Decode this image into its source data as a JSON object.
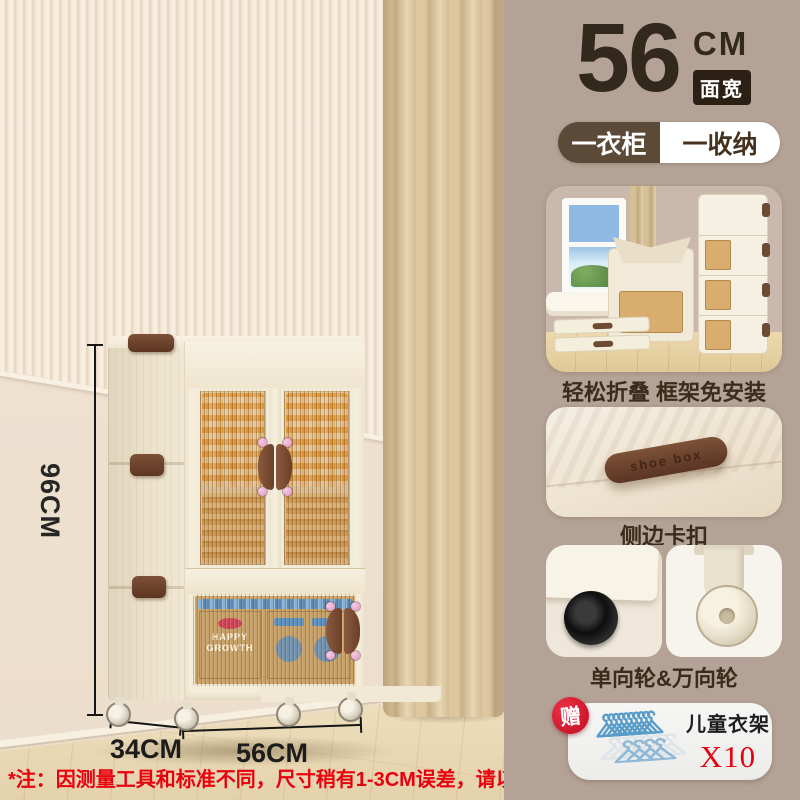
{
  "header": {
    "size_number": "56",
    "size_unit": "CM",
    "size_tag": "面宽",
    "pill_left": "一衣柜",
    "pill_right": "一收纳"
  },
  "dimensions": {
    "height": "96CM",
    "depth": "34CM",
    "width": "56CM"
  },
  "features": [
    {
      "caption": "轻松折叠 框架免安装"
    },
    {
      "caption": "侧边卡扣",
      "clip_text": "shoe box"
    },
    {
      "caption": "单向轮&万向轮"
    }
  ],
  "gift": {
    "badge": "赠",
    "name": "儿童衣架",
    "quantity": "X10"
  },
  "cabinet": {
    "box_line1": "HAPPY",
    "box_line2": "GROWTH"
  },
  "note": "*注：因测量工具和标准不同，尺寸稍有1-3CM误差，请以实物为准",
  "colors": {
    "sidebar_bg": "#b3a295",
    "accent_dark": "#33281c",
    "red": "#e60012",
    "cream": "#f3ecdc",
    "amber": "#d2a667",
    "clip_brown": "#6f4733",
    "pill_dark": "#5c4a38"
  }
}
